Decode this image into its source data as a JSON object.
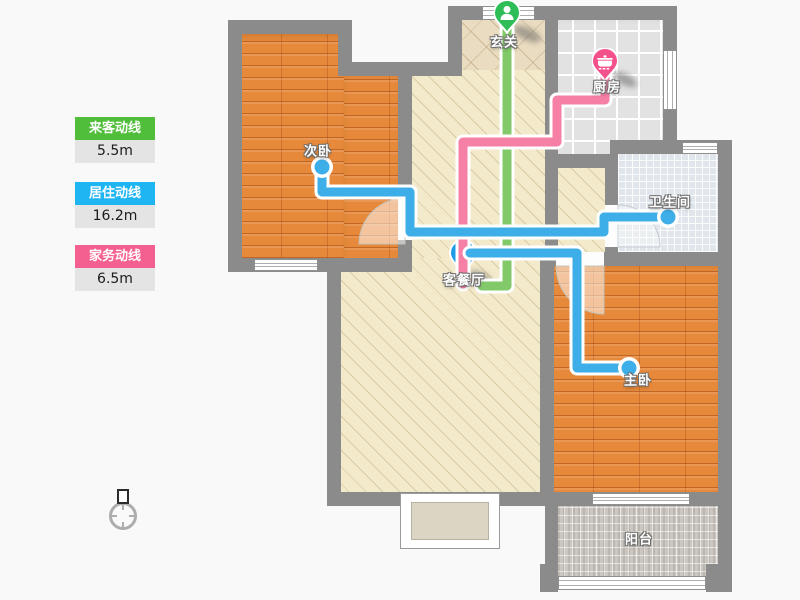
{
  "legend": {
    "items": [
      {
        "id": "guest",
        "label": "来客动线",
        "value": "5.5m",
        "color": "#50BE3A"
      },
      {
        "id": "resident",
        "label": "居住动线",
        "value": "16.2m",
        "color": "#1FB4F2"
      },
      {
        "id": "housework",
        "label": "家务动线",
        "value": "6.5m",
        "color": "#F4608F"
      }
    ]
  },
  "rooms": {
    "entry": {
      "name": "玄关"
    },
    "kitchen": {
      "name": "厨房"
    },
    "bedroom2": {
      "name": "次卧"
    },
    "bathroom": {
      "name": "卫生间"
    },
    "living": {
      "name": "客餐厅"
    },
    "master": {
      "name": "主卧"
    },
    "balcony": {
      "name": "阳台"
    }
  },
  "routes": {
    "guest": {
      "color": "#82C96A"
    },
    "resident": {
      "color": "#3EAEE8"
    },
    "housework": {
      "color": "#F57FA5"
    }
  },
  "markers": {
    "guest": {
      "icon": "person-icon",
      "color": "#2EBD57"
    },
    "resident": {
      "icon": "bed-icon",
      "color": "#1D9BE8"
    },
    "housework": {
      "icon": "pot-icon",
      "color": "#F4508C"
    }
  }
}
